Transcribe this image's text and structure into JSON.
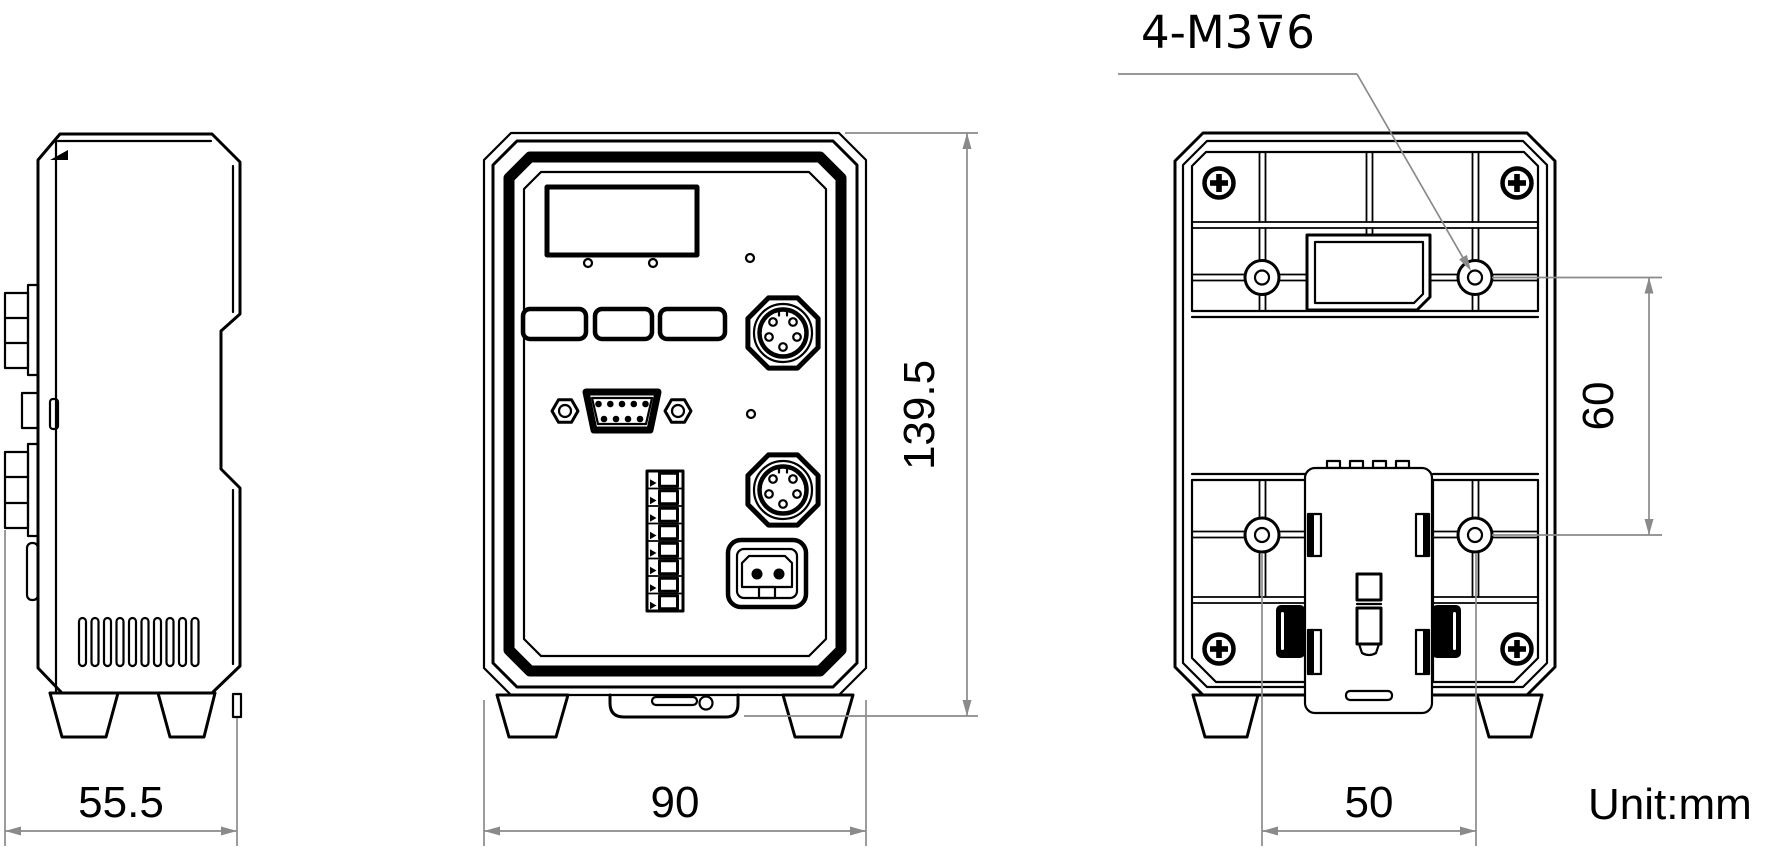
{
  "labels": {
    "thread_callout": "4-M3⊽6",
    "unit": "Unit:mm"
  },
  "dimensions": {
    "side_width_mm": "55.5",
    "front_width_mm": "90",
    "front_height_mm": "139.5",
    "mount_hole_vertical_spacing_mm": "60",
    "mount_hole_horizontal_spacing_mm": "50"
  },
  "colors": {
    "line": "#000000",
    "dimension": "#8a8a8a",
    "background": "#ffffff"
  }
}
